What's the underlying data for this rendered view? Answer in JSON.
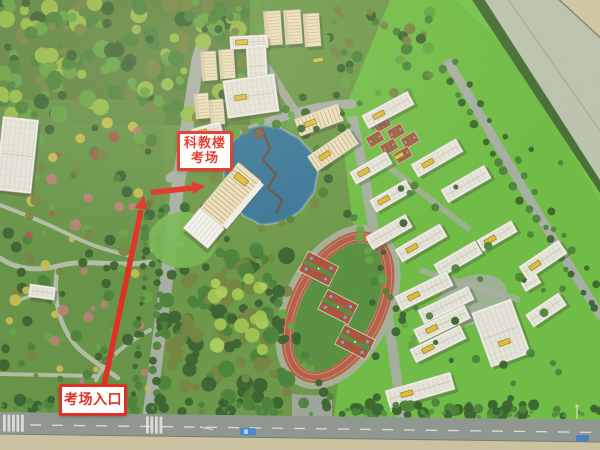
{
  "scene": {
    "description": "Aerial photograph of a campus architectural scale model used as an exam wayfinding map"
  },
  "annotations": {
    "building_label": {
      "line1": "科教楼",
      "line2": "考场"
    },
    "entrance_label": {
      "text": "考场入口"
    },
    "accent_color": "#e0241b",
    "label_bg": "#ffffff"
  },
  "palette": {
    "grass_base": "#64923f",
    "grass_forest": "#547c34",
    "park_grass": "#5d8d3f",
    "lawn": "#68b93c",
    "lawn_hi": "#79c94b",
    "band_dark": "#3d672c",
    "band_pale": "#b8c0ac",
    "band_beige": "#cdc5a1",
    "pond": "#2c6e92",
    "pond_edge": "#47869f",
    "track_ring": "#b2563d",
    "track_field": "#4f8a37",
    "track_apron": "#a0ac92",
    "court_red": "#a84a31",
    "court_blue": "#4ab4dd",
    "road": "#a2aa9f",
    "road_dark": "#8a918c",
    "path": "#b8bcac",
    "bottom_beige": "#c8bf9b",
    "bldg_white": "#f3f2ec",
    "bldg_roof": "#e2e0d6",
    "bldg_cream": "#ecdfbb",
    "cream_stripe": "#c0a474",
    "sign_yellow": "#dcb832",
    "hedge": "#2d5a22",
    "tree_dark": "#2f5a26",
    "tree_mid": "#417b2f",
    "tree_light": "#5f9e3c",
    "tree_yellow": "#92b840",
    "tree_olive": "#6e7e38",
    "tree_bright": "#9cc24b",
    "flower_pink": "#b27a6c",
    "flower_red": "#9e5540",
    "flower_yellow": "#c3b84a"
  }
}
